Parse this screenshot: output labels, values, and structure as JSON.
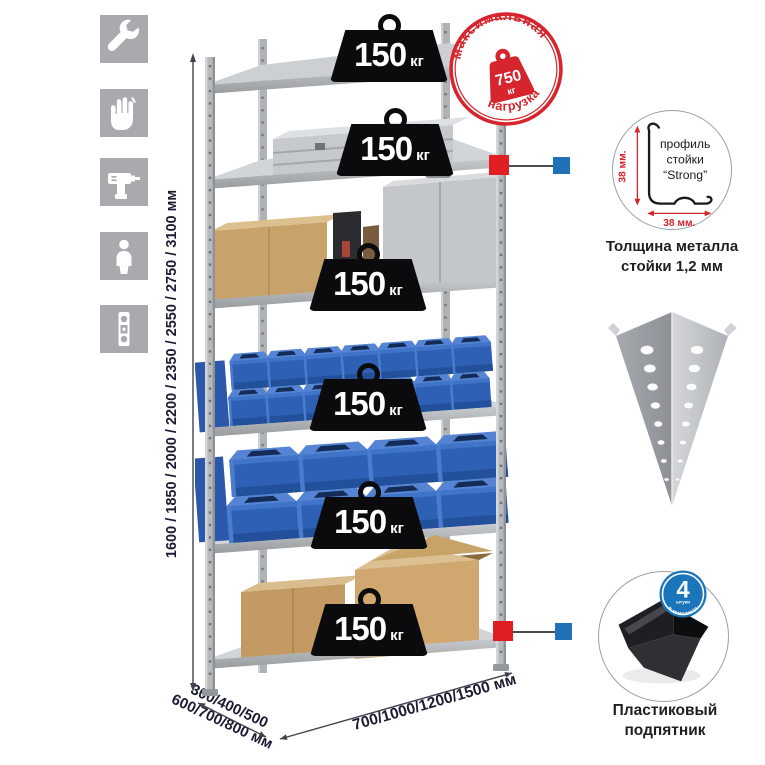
{
  "toolbar_icons": {
    "items": [
      "wrench-icon",
      "work-gloves-icon",
      "drill-icon",
      "person-icon",
      "spirit-level-icon"
    ]
  },
  "rack": {
    "shelf_loads": [
      {
        "value": "150",
        "unit": "кг"
      },
      {
        "value": "150",
        "unit": "кг"
      },
      {
        "value": "150",
        "unit": "кг"
      },
      {
        "value": "150",
        "unit": "кг"
      },
      {
        "value": "150",
        "unit": "кг"
      },
      {
        "value": "150",
        "unit": "кг"
      }
    ]
  },
  "max_load_stamp": {
    "arc_top": "максимальная",
    "arc_bottom": "нагрузка",
    "value": "750",
    "unit": "кг"
  },
  "dimensions": {
    "height_options": "1600 / 1850 / 2000 / 2200 / 2350 / 2550 / 2750 / 3100 мм",
    "depth_options_line1": "300/400/500",
    "depth_options_line2": "600/700/800 мм",
    "width_options": "700/1000/1200/1500 мм"
  },
  "profile_detail": {
    "label_line1": "профиль",
    "label_line2": "стойки",
    "label_line3": "“Strong”",
    "dim_vertical": "38 мм.",
    "dim_horizontal": "38 мм.",
    "caption_line1": "Толщина металла",
    "caption_line2": "стойки 1,2 мм"
  },
  "foot_detail": {
    "badge_count": "4",
    "badge_count_sub": "штуки",
    "badge_arc": "в комплекте",
    "caption_line1": "Пластиковый",
    "caption_line2": "подпятник"
  },
  "colors": {
    "stamp_red": "#d6252c",
    "marker_red": "#e21e25",
    "marker_blue": "#1f72b8",
    "badge_blue": "#1b75bb",
    "bin_blue": "#2e61b5"
  }
}
